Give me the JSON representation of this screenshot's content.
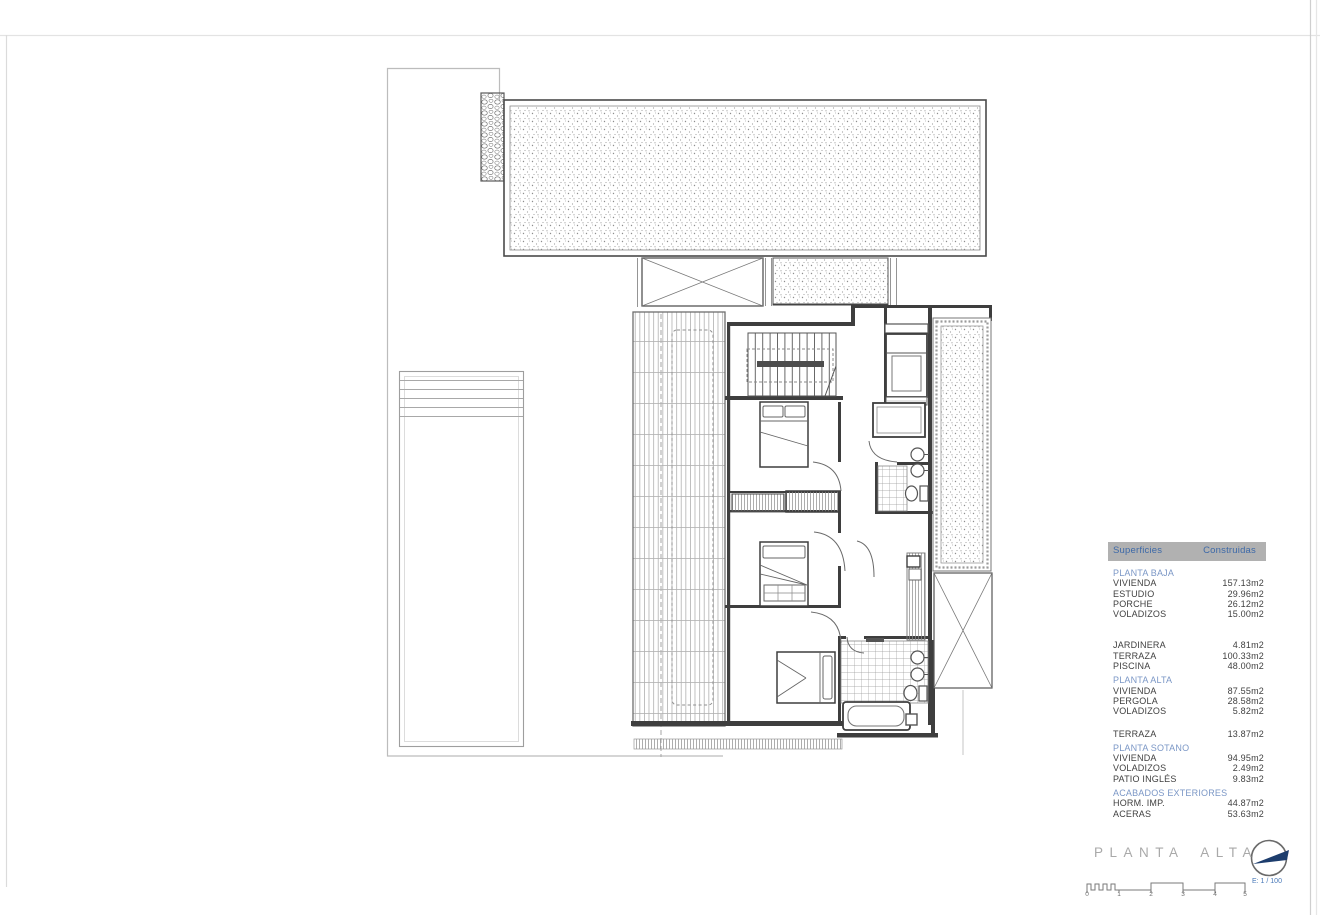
{
  "title_block": {
    "title": "PLANTA ALTA",
    "scale_label": "E: 1 / 100",
    "scale_ticks": [
      "0",
      "1",
      "2",
      "3",
      "4",
      "5"
    ],
    "north_icon": "north-arrow-icon"
  },
  "areas_table": {
    "header": {
      "surfaces": "Superficies",
      "built": "Construidas"
    },
    "rows": [
      {
        "type": "section",
        "label": "PLANTA BAJA"
      },
      {
        "type": "item",
        "label": "VIVIENDA",
        "value": "157.13m2"
      },
      {
        "type": "item",
        "label": "ESTUDIO",
        "value": "29.96m2"
      },
      {
        "type": "item",
        "label": "PORCHE",
        "value": "26.12m2"
      },
      {
        "type": "item",
        "label": "VOLADIZOS",
        "value": "15.00m2"
      },
      {
        "type": "item",
        "label": "JARDINERA",
        "value": "4.81m2"
      },
      {
        "type": "item",
        "label": "TERRAZA",
        "value": "100.33m2"
      },
      {
        "type": "item",
        "label": "PISCINA",
        "value": "48.00m2"
      },
      {
        "type": "section",
        "label": "PLANTA ALTA"
      },
      {
        "type": "item",
        "label": "VIVIENDA",
        "value": "87.55m2"
      },
      {
        "type": "item",
        "label": "PERGOLA",
        "value": "28.58m2"
      },
      {
        "type": "item",
        "label": "VOLADIZOS",
        "value": "5.82m2"
      },
      {
        "type": "item",
        "label": "TERRAZA",
        "value": "13.87m2"
      },
      {
        "type": "section",
        "label": "PLANTA SOTANO"
      },
      {
        "type": "item",
        "label": "VIVIENDA",
        "value": "94.95m2"
      },
      {
        "type": "item",
        "label": "VOLADIZOS",
        "value": "2.49m2"
      },
      {
        "type": "item",
        "label": "PATIO INGLÉS",
        "value": "9.83m2"
      },
      {
        "type": "section",
        "label": "ACABADOS EXTERIORES"
      },
      {
        "type": "item",
        "label": "HORM. IMP.",
        "value": "44.87m2"
      },
      {
        "type": "item",
        "label": "ACERAS",
        "value": "53.63m2"
      }
    ]
  },
  "colors": {
    "accent_blue": "#3d69a8",
    "section_blue": "#7b97c6",
    "table_header_bg": "#b1b1b1",
    "text": "#3f3f3f",
    "title_gray": "#a9a9a9",
    "wall": "#3e3e3e",
    "compass_navy": "#1d3d6d"
  }
}
